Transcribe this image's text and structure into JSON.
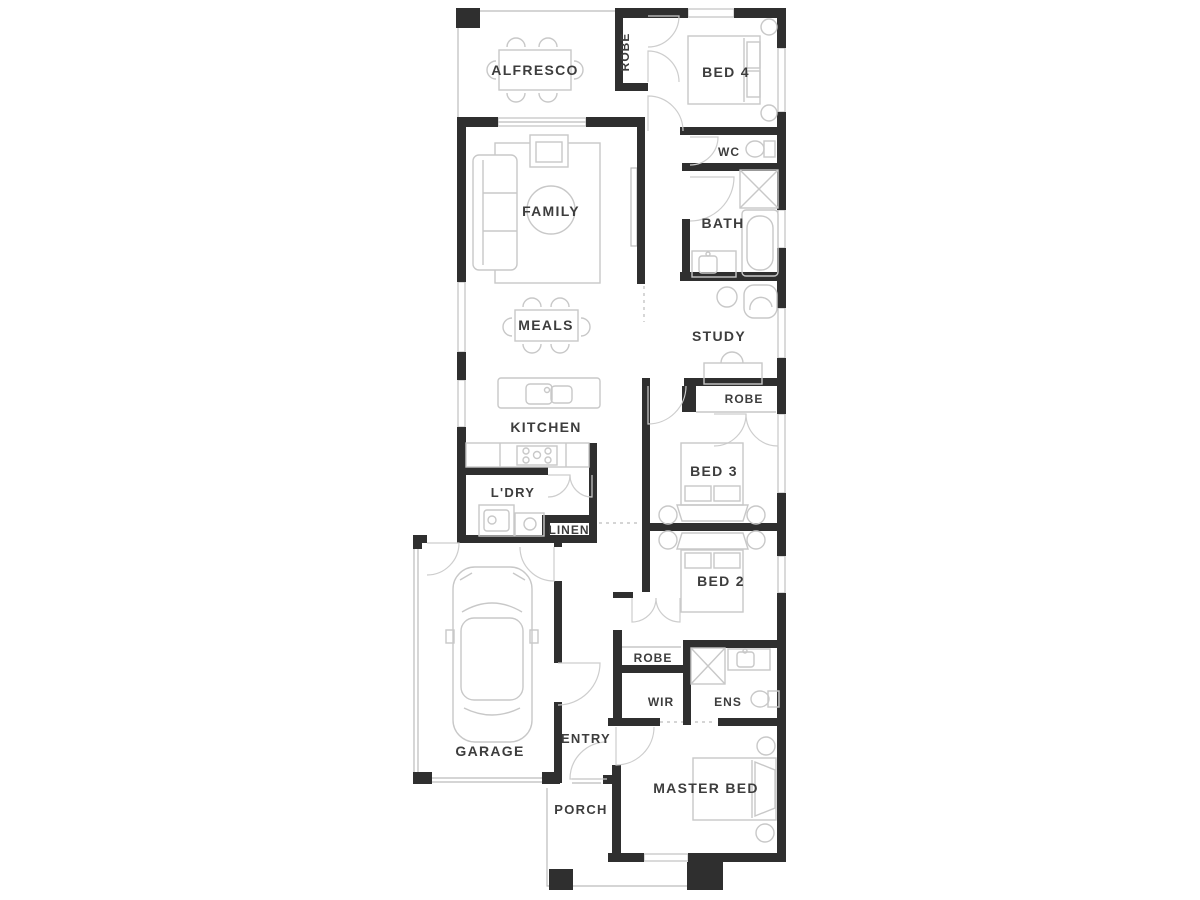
{
  "plan": {
    "title": "Single storey house floor plan",
    "colors": {
      "wall": "#2f2f2f",
      "window": "#bcbcbc",
      "door": "#cdcdcd",
      "furniture": "#c8c8c8",
      "text": "#3d3d3d"
    },
    "rooms": [
      {
        "id": "alfresco",
        "label": "ALFRESCO"
      },
      {
        "id": "robe-bed4",
        "label": "ROBE"
      },
      {
        "id": "bed4",
        "label": "BED 4"
      },
      {
        "id": "wc",
        "label": "WC"
      },
      {
        "id": "bath",
        "label": "BATH"
      },
      {
        "id": "family",
        "label": "FAMILY"
      },
      {
        "id": "meals",
        "label": "MEALS"
      },
      {
        "id": "study",
        "label": "STUDY"
      },
      {
        "id": "kitchen",
        "label": "KITCHEN"
      },
      {
        "id": "robe-bed3",
        "label": "ROBE"
      },
      {
        "id": "bed3",
        "label": "BED 3"
      },
      {
        "id": "ldry",
        "label": "L'DRY"
      },
      {
        "id": "linen",
        "label": "LINEN"
      },
      {
        "id": "bed2",
        "label": "BED 2"
      },
      {
        "id": "robe-wir",
        "label": "ROBE"
      },
      {
        "id": "wir",
        "label": "WIR"
      },
      {
        "id": "ens",
        "label": "ENS"
      },
      {
        "id": "garage",
        "label": "GARAGE"
      },
      {
        "id": "entry",
        "label": "ENTRY"
      },
      {
        "id": "master",
        "label": "MASTER BED"
      },
      {
        "id": "porch",
        "label": "PORCH"
      }
    ]
  }
}
